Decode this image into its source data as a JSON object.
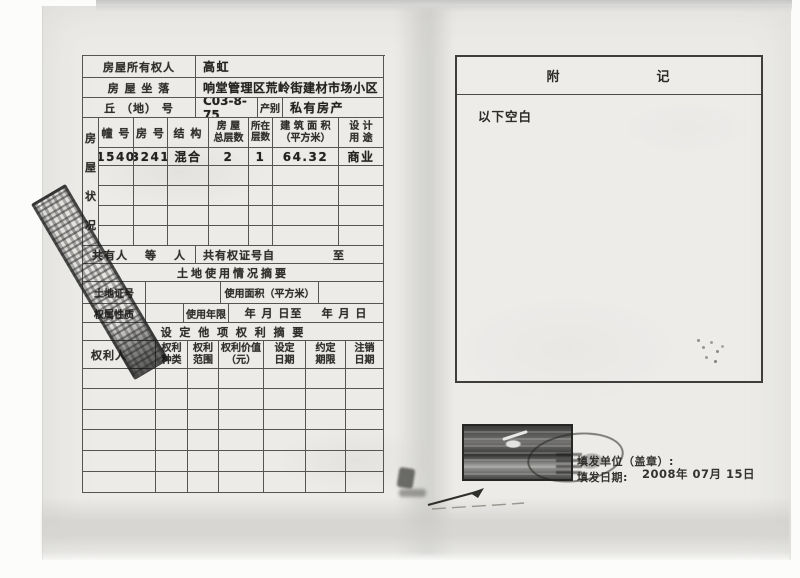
{
  "info": {
    "owner_label": "房屋所有权人",
    "owner_value": "高虹",
    "location_label": "房 屋  坐 落",
    "location_value": "响堂管理区荒岭街建材市场小区",
    "plot_label": "丘 （地） 号",
    "plot_value": "C03-8-75",
    "category_label": "产别",
    "category_value": "私有房产"
  },
  "house": {
    "status_chars": [
      "房",
      "屋",
      "状",
      "况"
    ],
    "headers": {
      "building": "幢 号",
      "room": "房 号",
      "structure": "结 构",
      "total_l1": "房 屋",
      "total_l2": "总层数",
      "floor_l1": "所在",
      "floor_l2": "层数",
      "area_l1": "建 筑 面 积",
      "area_l2": "（平方米）",
      "use_l1": "设 计",
      "use_l2": "用 途"
    },
    "values": {
      "building": "1540",
      "room": "3241",
      "structure": "混合",
      "total": "2",
      "floor": "1",
      "area": "64.32",
      "use": "商业"
    }
  },
  "co_owner": {
    "label": "共有人",
    "deng": "等",
    "ren": "人",
    "cert_from": "共有权证号自",
    "to": "至"
  },
  "land": {
    "section_title": "土地使用情况摘要",
    "cert_label": "土地证号",
    "area_label": "使用面积（平方米）",
    "tenure_label": "权属性质",
    "years_label": "使用年限",
    "from_date": "年  月  日至",
    "to_date": "年  月  日"
  },
  "rights": {
    "section_title": "设 定 他 项 权 利 摘 要",
    "headers": {
      "holder": "权利人",
      "kind_l1": "权利",
      "kind_l2": "种类",
      "scope_l1": "权利",
      "scope_l2": "范围",
      "value_l1": "权利价值",
      "value_l2": "（元）",
      "set_l1": "设定",
      "set_l2": "日期",
      "term_l1": "约定",
      "term_l2": "期限",
      "cancel_l1": "注销",
      "cancel_l2": "日期"
    }
  },
  "remarks": {
    "title_a": "附",
    "title_b": "记",
    "body": "以下空白"
  },
  "footer": {
    "issuer_label": "填发单位（盖章）:",
    "date_label": "填发日期:",
    "date_value": "2008年 07月 15日"
  },
  "colors": {
    "paper": "#ecebe8",
    "ink": "#2c2b2a",
    "table_line": "#555555",
    "stamp_ink": "#1c1c1c"
  }
}
